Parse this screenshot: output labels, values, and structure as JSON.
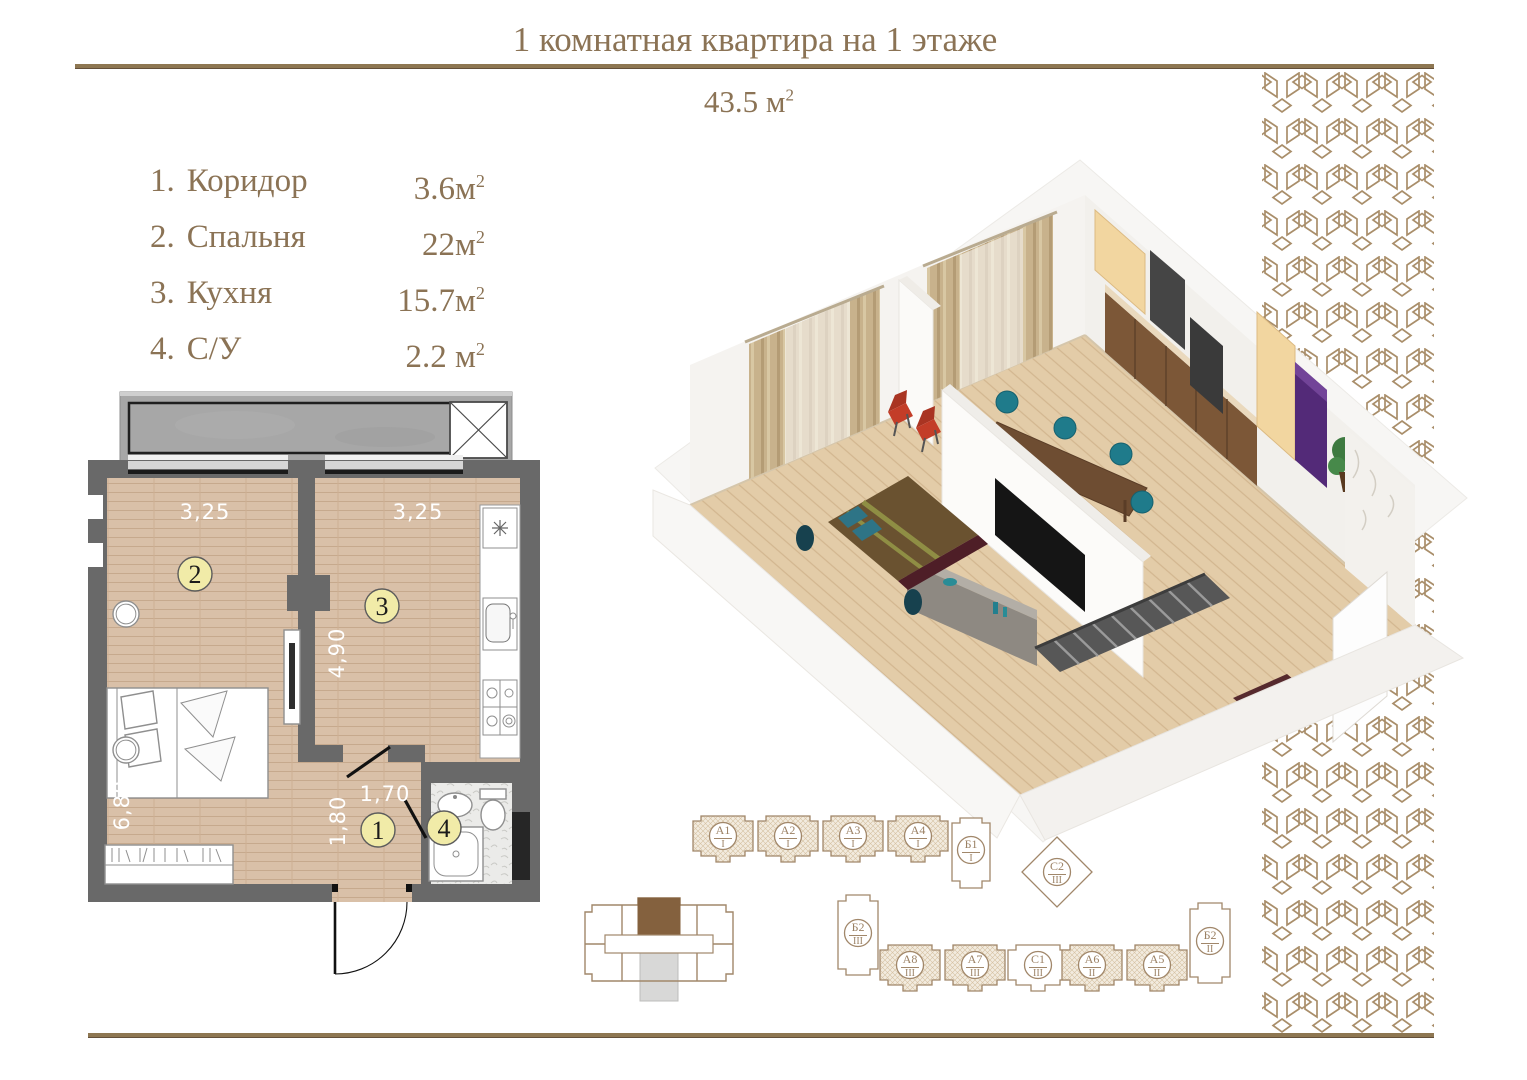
{
  "colors": {
    "accent_brown": "#8b7355",
    "rule_brown": "#8e7752",
    "pattern_brown": "#a98e6a",
    "wall_gray": "#696969",
    "floor_wood": "#d9c0a8",
    "room_badge_yellow": "#f1eba8",
    "key_unit_brown": "#84613e"
  },
  "header": {
    "title": "1 комнатная квартира на 1 этаже",
    "total_area": "43.5 м",
    "sup": "2"
  },
  "room_list": [
    {
      "num": "1.",
      "name": "Коридор",
      "area": "3.6м",
      "sup": "2"
    },
    {
      "num": "2.",
      "name": "Спальня",
      "area": "22м",
      "sup": "2"
    },
    {
      "num": "3.",
      "name": "Кухня",
      "area": "15.7м",
      "sup": "2"
    },
    {
      "num": "4.",
      "name": "С/У",
      "area": "2.2 м",
      "sup": "2"
    }
  ],
  "floorplan": {
    "dims": {
      "bedroom_w": "3,25",
      "kitchen_w": "3,25",
      "kitchen_d": "4,90",
      "bedroom_d": "6,80",
      "hall_d": "1,80",
      "hall_w": "1,70"
    },
    "labels": {
      "hall": "1",
      "bedroom": "2",
      "kitchen": "3",
      "bath": "4"
    }
  },
  "siteplan": {
    "blocks": [
      {
        "name": "А1",
        "level": "I"
      },
      {
        "name": "А2",
        "level": "I"
      },
      {
        "name": "А3",
        "level": "I"
      },
      {
        "name": "А4",
        "level": "I"
      },
      {
        "name": "Б1",
        "level": "I"
      },
      {
        "name": "С2",
        "level": "III"
      },
      {
        "name": "Б2",
        "level": "III"
      },
      {
        "name": "А8",
        "level": "III"
      },
      {
        "name": "А7",
        "level": "III"
      },
      {
        "name": "С1",
        "level": "III"
      },
      {
        "name": "А6",
        "level": "II"
      },
      {
        "name": "А5",
        "level": "II"
      },
      {
        "name": "Б2",
        "level": "II"
      }
    ]
  }
}
